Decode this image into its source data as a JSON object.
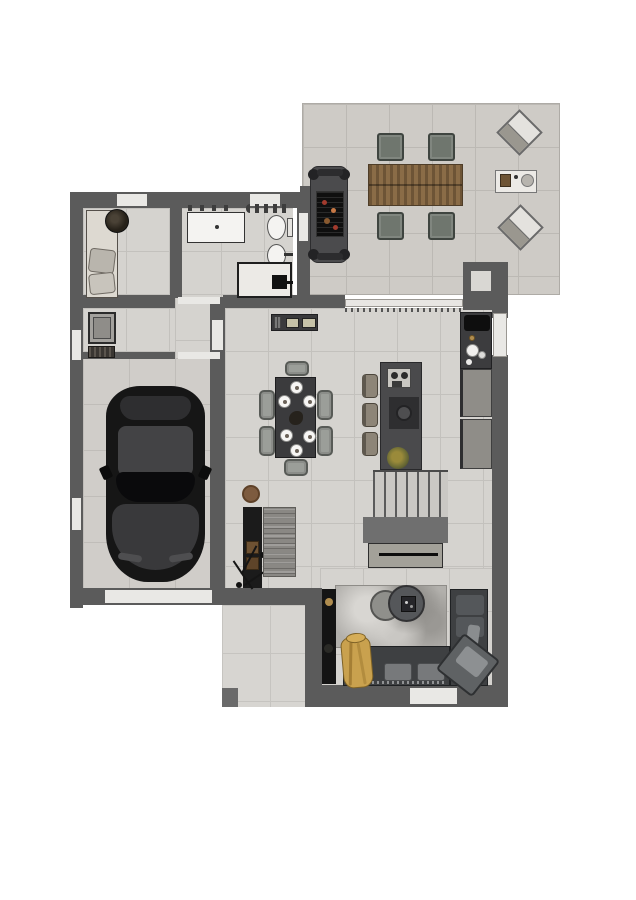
{
  "palette": {
    "wall": "#5b5b5b",
    "floor": "#d5d3cf",
    "grout": "#c3c1bd",
    "terrace": "#cecbc6",
    "garage": "#d0cdc9",
    "porch": "#d7d5d1",
    "opening": "#e9e8e5",
    "car": "#161616",
    "wood": "#8a6c47",
    "woodDark": "#6d5436",
    "ochair": "#6f766e",
    "dchair": "#9b9e99",
    "sofa": "#3e4042",
    "sofaCushion": "#54575a",
    "rug": "#b2b0ac",
    "runner": "#8a8884",
    "yellow": "#c9a14e",
    "pouf": "#7d5b3f",
    "island": "#4a4a4c",
    "counter": "#3c3c3e",
    "cabinet": "#8f8d88",
    "tread": "#cac8c4",
    "landing": "#6f6f6f",
    "gold": "#b08d4f",
    "fixtureWhite": "#f4f3f1"
  },
  "plan": {
    "type": "floor-plan",
    "view": "top-down",
    "rooms": [
      {
        "id": "terrace",
        "name": "terrace",
        "furniture": [
          "bbq-grill",
          "outdoor-dining-table",
          "4-outdoor-chairs",
          "2-sun-loungers",
          "outdoor-side-table"
        ]
      },
      {
        "id": "entry",
        "name": "entry-hall",
        "furniture": [
          "bench-daybed",
          "cushions",
          "potted-plant"
        ]
      },
      {
        "id": "bathroom",
        "name": "bathroom",
        "furniture": [
          "vanity-sink",
          "toilet",
          "bidet",
          "shower",
          "towel-radiator"
        ]
      },
      {
        "id": "laundry",
        "name": "laundry-nook",
        "furniture": [
          "washing-machine",
          "laundry-basket"
        ]
      },
      {
        "id": "garage",
        "name": "garage",
        "furniture": [
          "car"
        ]
      },
      {
        "id": "dining",
        "name": "dining-area",
        "furniture": [
          "dining-table",
          "6-dining-chairs",
          "6-place-settings",
          "centerpiece-plant",
          "sideboard",
          "round-pouf",
          "tall-storage-cabinet",
          "coat-stand",
          "runner-rug"
        ]
      },
      {
        "id": "kitchen",
        "name": "kitchen",
        "furniture": [
          "kitchen-island",
          "hob",
          "coffee-station",
          "3-bar-stools",
          "wall-counter-with-sink",
          "base-cabinets",
          "plant"
        ]
      },
      {
        "id": "stairs",
        "name": "staircase",
        "furniture": [
          "stair-treads",
          "landing",
          "understair-sideboard"
        ]
      },
      {
        "id": "living",
        "name": "living-room",
        "furniture": [
          "l-shaped-sofa",
          "chaise-lounge-chair",
          "yellow-armchair",
          "round-coffee-table-large",
          "round-coffee-table-small",
          "area-rug",
          "media-console"
        ]
      },
      {
        "id": "porch",
        "name": "porch",
        "furniture": []
      }
    ]
  }
}
